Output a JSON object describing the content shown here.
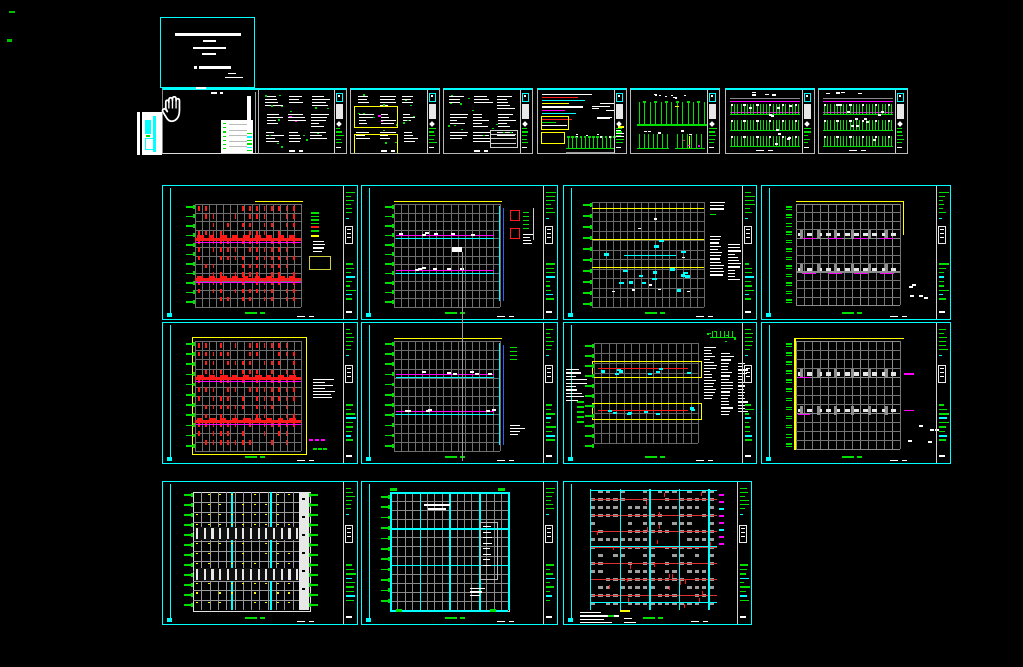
{
  "window": {
    "width": 1023,
    "height": 667,
    "background": "#000000"
  },
  "palette": {
    "cyan": "#00ffff",
    "green": "#00e000",
    "bright_green": "#00ff00",
    "red": "#ff1a1a",
    "magenta": "#ff00ff",
    "yellow": "#ffff00",
    "white": "#ffffff",
    "gray": "#6e6e6e",
    "light_gray": "#b8b8b8",
    "blue": "#2e62ff"
  },
  "cursor": {
    "type": "pan-hand",
    "x": 160,
    "y": 92,
    "width": 27,
    "height": 35
  },
  "construction_line": {
    "x": 462,
    "y1": 252,
    "y2": 461,
    "color": "#9a9a9a",
    "cap": {
      "x": 452,
      "y": 247,
      "w": 10,
      "h": 5
    }
  },
  "corner_marks": [
    {
      "x": 9,
      "y": 11,
      "w": 6,
      "h": 2,
      "color": "#00c000"
    },
    {
      "x": 7,
      "y": 39,
      "w": 5,
      "h": 3,
      "color": "#00c000"
    }
  ],
  "overlay_marks": [
    {
      "x": 196,
      "y": 87,
      "w": 10,
      "h": 2,
      "color": "#ffffff"
    }
  ],
  "sheets": [
    {
      "name": "cover-sheet",
      "kind": "cover",
      "x": 160,
      "y": 17,
      "w": 95,
      "h": 71,
      "seed": 11
    },
    {
      "name": "legend-preview-sheet",
      "kind": "preview",
      "x": 137,
      "y": 112,
      "w": 25,
      "h": 43,
      "seed": 12
    },
    {
      "name": "notes-sheet",
      "kind": "darksheet",
      "x": 162,
      "y": 88,
      "w": 96,
      "h": 66,
      "seed": 13
    },
    {
      "name": "schedule-sheet-1",
      "kind": "schedule",
      "x": 258,
      "y": 88,
      "w": 89,
      "h": 66,
      "seed": 21,
      "opts": {
        "m": true
      }
    },
    {
      "name": "schedule-sheet-2",
      "kind": "schedule",
      "x": 350,
      "y": 88,
      "w": 90,
      "h": 66,
      "seed": 22,
      "opts": {
        "m": true,
        "yb": true
      }
    },
    {
      "name": "schedule-sheet-3",
      "kind": "schedule",
      "x": 443,
      "y": 88,
      "w": 90,
      "h": 66,
      "seed": 23,
      "opts": {
        "table": true
      }
    },
    {
      "name": "system-diagram-sheet",
      "kind": "colorbars",
      "x": 537,
      "y": 88,
      "w": 90,
      "h": 66,
      "seed": 24
    },
    {
      "name": "riser-diagram-sheet",
      "kind": "riser",
      "x": 630,
      "y": 88,
      "w": 90,
      "h": 66,
      "seed": 25
    },
    {
      "name": "distribution-sheet-1",
      "kind": "panelgreen",
      "x": 725,
      "y": 88,
      "w": 90,
      "h": 66,
      "seed": 26
    },
    {
      "name": "distribution-sheet-2",
      "kind": "panelgreen",
      "x": 818,
      "y": 88,
      "w": 90,
      "h": 66,
      "seed": 27
    },
    {
      "name": "lighting-plan-1",
      "kind": "planRed",
      "x": 162,
      "y": 185,
      "w": 196,
      "h": 135,
      "seed": 31,
      "opts": {
        "legend": true
      }
    },
    {
      "name": "power-plan-1",
      "kind": "planCyan",
      "x": 361,
      "y": 185,
      "w": 197,
      "h": 135,
      "seed": 32,
      "opts": {
        "detail": true
      }
    },
    {
      "name": "tray-plan-1",
      "kind": "planTray",
      "x": 563,
      "y": 185,
      "w": 194,
      "h": 135,
      "seed": 33
    },
    {
      "name": "sparse-plan-1",
      "kind": "planMag",
      "x": 761,
      "y": 185,
      "w": 190,
      "h": 135,
      "seed": 34,
      "opts": {
        "L": "tr"
      }
    },
    {
      "name": "lighting-plan-2",
      "kind": "planRed",
      "x": 162,
      "y": 322,
      "w": 196,
      "h": 142,
      "seed": 35,
      "opts": {
        "frame": true,
        "textblock": true
      }
    },
    {
      "name": "power-plan-2",
      "kind": "planCyan",
      "x": 361,
      "y": 322,
      "w": 197,
      "h": 142,
      "seed": 36,
      "opts": {}
    },
    {
      "name": "tray-plan-2",
      "kind": "planSched",
      "x": 563,
      "y": 322,
      "w": 194,
      "h": 142,
      "seed": 37
    },
    {
      "name": "sparse-plan-2",
      "kind": "planMag",
      "x": 761,
      "y": 322,
      "w": 190,
      "h": 142,
      "seed": 38,
      "opts": {
        "L": "lt"
      }
    },
    {
      "name": "fixture-plan",
      "kind": "fixture",
      "x": 162,
      "y": 481,
      "w": 196,
      "h": 144,
      "seed": 41
    },
    {
      "name": "outlet-plan",
      "kind": "powerGrid",
      "x": 361,
      "y": 481,
      "w": 197,
      "h": 144,
      "seed": 42
    },
    {
      "name": "ceiling-plan",
      "kind": "blockGrid",
      "x": 563,
      "y": 481,
      "w": 189,
      "h": 144,
      "seed": 43
    }
  ]
}
